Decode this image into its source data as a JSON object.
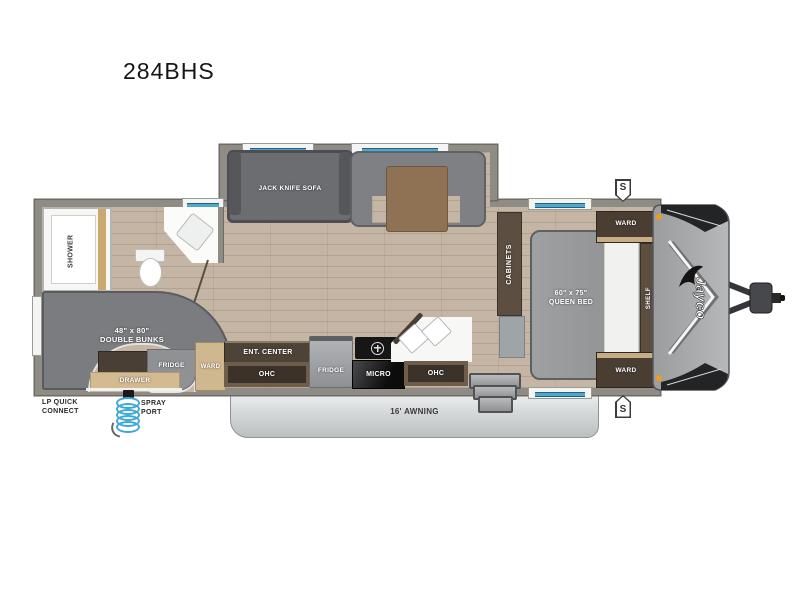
{
  "title": "284BHS",
  "brand": "Jayco",
  "badges": {
    "speaker": "S"
  },
  "colors": {
    "floor_wood": "#c4b5a4",
    "wall_gray": "#8f8b85",
    "window_blue": "#4fa8cf",
    "marker_orange": "#f2991f",
    "awning_gray": "#d3d6d7",
    "cabinet_brown": "#4e4337",
    "cabinet_tan": "#cfb78f",
    "spray_hose_blue": "#3fa8d6"
  },
  "slideout": {
    "sofa_label": "JACK KNIFE SOFA"
  },
  "bathroom": {
    "shower_label": "SHOWER"
  },
  "bunk_room": {
    "size_label": "48\" x 80\"",
    "name_label": "DOUBLE BUNKS",
    "fridge_label": "FRIDGE",
    "drawer_label": "DRAWER"
  },
  "kitchen": {
    "ward_label": "WARD",
    "ent_center_label": "ENT. CENTER",
    "ohc_left_label": "OHC",
    "fridge_label": "FRIDGE",
    "micro_label": "MICRO",
    "ohc_right_label": "OHC"
  },
  "bedroom": {
    "cabinets_label": "CABINETS",
    "bed_size_label": "60\" x 75\"",
    "bed_name_label": "QUEEN BED",
    "ward_top_label": "WARD",
    "shelf_label": "SHELF",
    "ward_bottom_label": "WARD"
  },
  "exterior": {
    "awning_label": "16' AWNING",
    "lp_label_line1": "LP QUICK",
    "lp_label_line2": "CONNECT",
    "spray_label_line1": "SPRAY",
    "spray_label_line2": "PORT"
  }
}
